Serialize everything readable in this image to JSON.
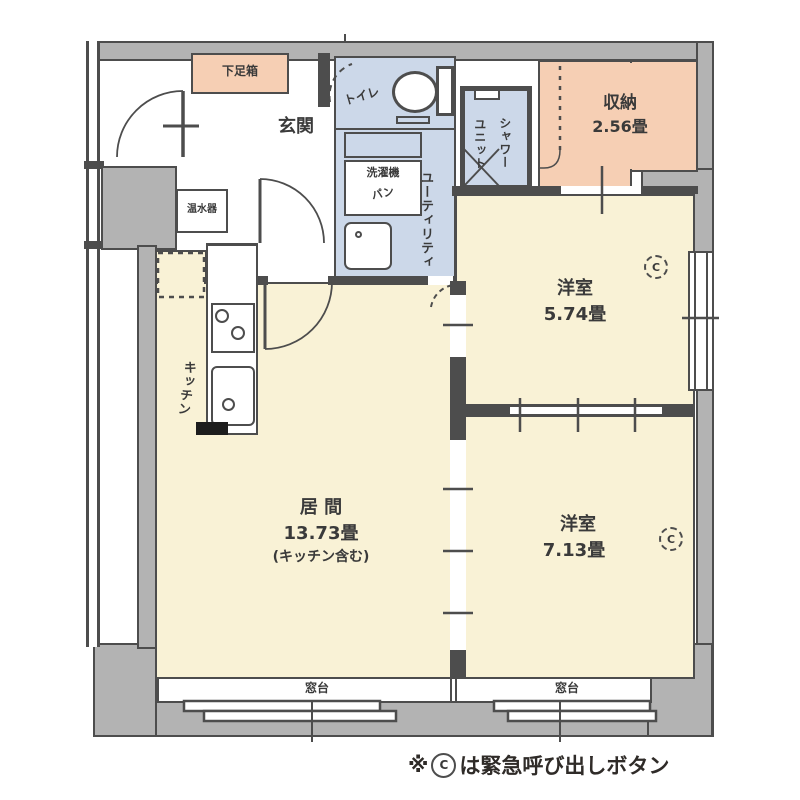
{
  "plan": {
    "shoe_box": {
      "label": "下足箱"
    },
    "genkan": {
      "label": "玄関"
    },
    "toilet": {
      "label": "トイレ"
    },
    "water_heater": {
      "label": "温水器"
    },
    "washer_pan": {
      "line1": "洗濯機",
      "line2": "パン"
    },
    "utility": {
      "label": "ユーティリティ"
    },
    "shower_unit": {
      "col_right": "シャワー",
      "col_left": "ユニット"
    },
    "closet": {
      "label": "収納",
      "size": "2.56畳"
    },
    "western_room_1": {
      "label": "洋室",
      "size": "5.74畳",
      "call_button": "C"
    },
    "western_room_2": {
      "label": "洋室",
      "size": "7.13畳",
      "call_button": "C"
    },
    "living_room": {
      "label": "居 間",
      "size": "13.73畳",
      "note": "(キッチン含む)"
    },
    "kitchen": {
      "label": "キッチン"
    },
    "window_sill_left": {
      "label": "窓台"
    },
    "window_sill_right": {
      "label": "窓台"
    }
  },
  "footer": {
    "prefix": "※",
    "call_button": "C",
    "text": "は緊急呼び出しボタン"
  },
  "colors": {
    "room_cream": "#f9f2d6",
    "wet_area_blue": "#ccd8e9",
    "storage_salmon": "#f6cfb4",
    "wall_gray": "#b3b3b3",
    "line_dark": "#4d4d4d"
  }
}
